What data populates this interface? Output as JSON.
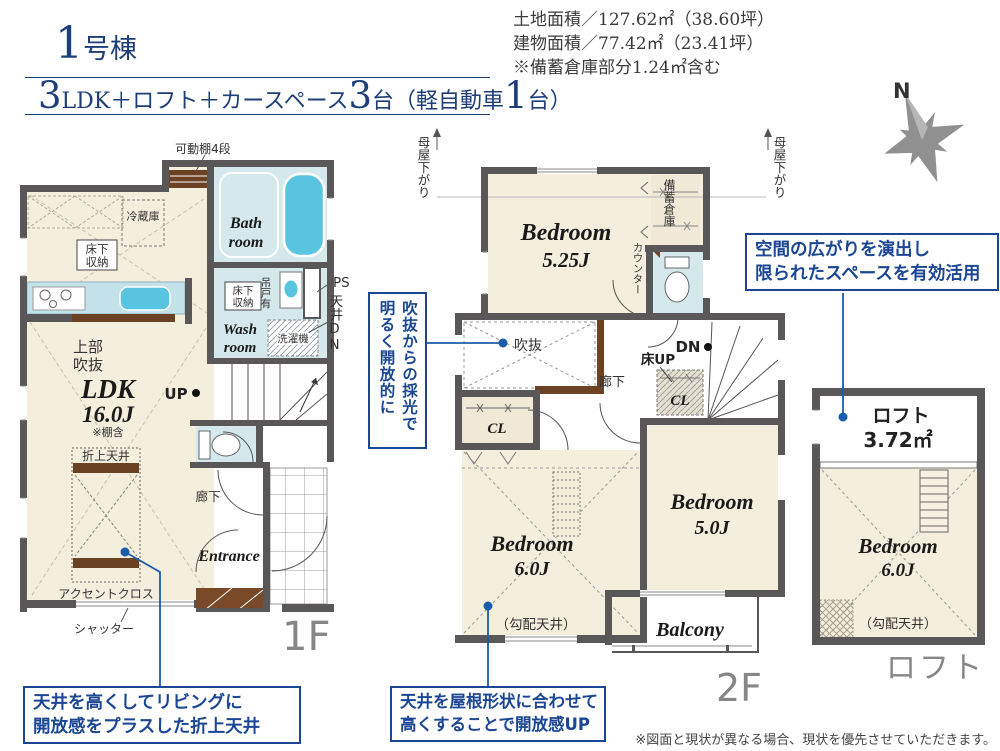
{
  "header": {
    "building_number": "1",
    "building_suffix": "号棟",
    "plan": {
      "n1": "3",
      "t1": "LDK＋ロフト＋カースペース",
      "n2": "3",
      "t2": "台（軽自動車",
      "n3": "1",
      "t3": "台）"
    },
    "land_area": "土地面積／127.62㎡（38.60坪）",
    "building_area": "建物面積／77.42㎡（23.41坪）",
    "storage_note": "※備蓄倉庫部分1.24㎡含む"
  },
  "compass": {
    "north": "N"
  },
  "floor1": {
    "floor_label": "1F",
    "movable_shelf": "可動棚4段",
    "fridge": "冷蔵庫",
    "underfloor_1": "床下",
    "underfloor_2": "収納",
    "bath_1": "Bath",
    "bath_2": "room",
    "wash_1": "Wash",
    "wash_2": "room",
    "wash_underfloor_1": "床下",
    "wash_underfloor_2": "収納",
    "hanging": "吊戸有",
    "ps": "PS",
    "ceiling_dn": "天井DN",
    "washer": "洗濯機",
    "upper_void_1": "上部",
    "upper_void_2": "吹抜",
    "ldk": "LDK",
    "ldk_size": "16.0J",
    "shelf_incl": "※棚含",
    "up": "UP",
    "oriage": "折上天井",
    "accent": "アクセントクロス",
    "shutter": "シャッター",
    "hallway": "廊下",
    "entrance": "Entrance"
  },
  "floor2": {
    "floor_label": "2F",
    "moya": "母屋下がり",
    "bedroom1": "Bedroom",
    "bedroom1_size": "5.25J",
    "storage": "備蓄倉庫",
    "counter": "カウンター",
    "void": "吹抜",
    "hallway": "廊下",
    "floor_up": "床UP",
    "dn": "DN",
    "cl_a": "CL",
    "cl_b": "CL",
    "bedroom2": "Bedroom",
    "bedroom2_size": "6.0J",
    "slope_note": "（勾配天井）",
    "bedroom3": "Bedroom",
    "bedroom3_size": "5.0J",
    "balcony": "Balcony"
  },
  "loft": {
    "floor_label": "ロフト",
    "name": "ロフト",
    "area": "3.72㎡",
    "bedroom": "Bedroom",
    "bedroom_size": "6.0J",
    "slope_note": "（勾配天井）"
  },
  "callouts": {
    "void_light_1": "吹抜からの採光で",
    "void_light_2": "明るく開放的に",
    "space_1": "空間の広がりを演出し",
    "space_2": "限られたスペースを有効活用",
    "coffered_1": "天井を高くしてリビングに",
    "coffered_2": "開放感をプラスした折上天井",
    "roof_1": "天井を屋根形状に合わせて",
    "roof_2": "高くすることで開放感UP"
  },
  "disclaimer": "※図面と現状が異なる場合、現状を優先させていただきます。",
  "colors": {
    "navy": "#1d3e78",
    "callout_blue": "#1b4693",
    "leader_blue": "#1b5cab",
    "wall": "#595757",
    "floor": "#f4eedd",
    "water": "#d5e8ec",
    "tub": "#58c4e0",
    "wood": "#6b4224",
    "gray_label": "#8a8a8a"
  }
}
